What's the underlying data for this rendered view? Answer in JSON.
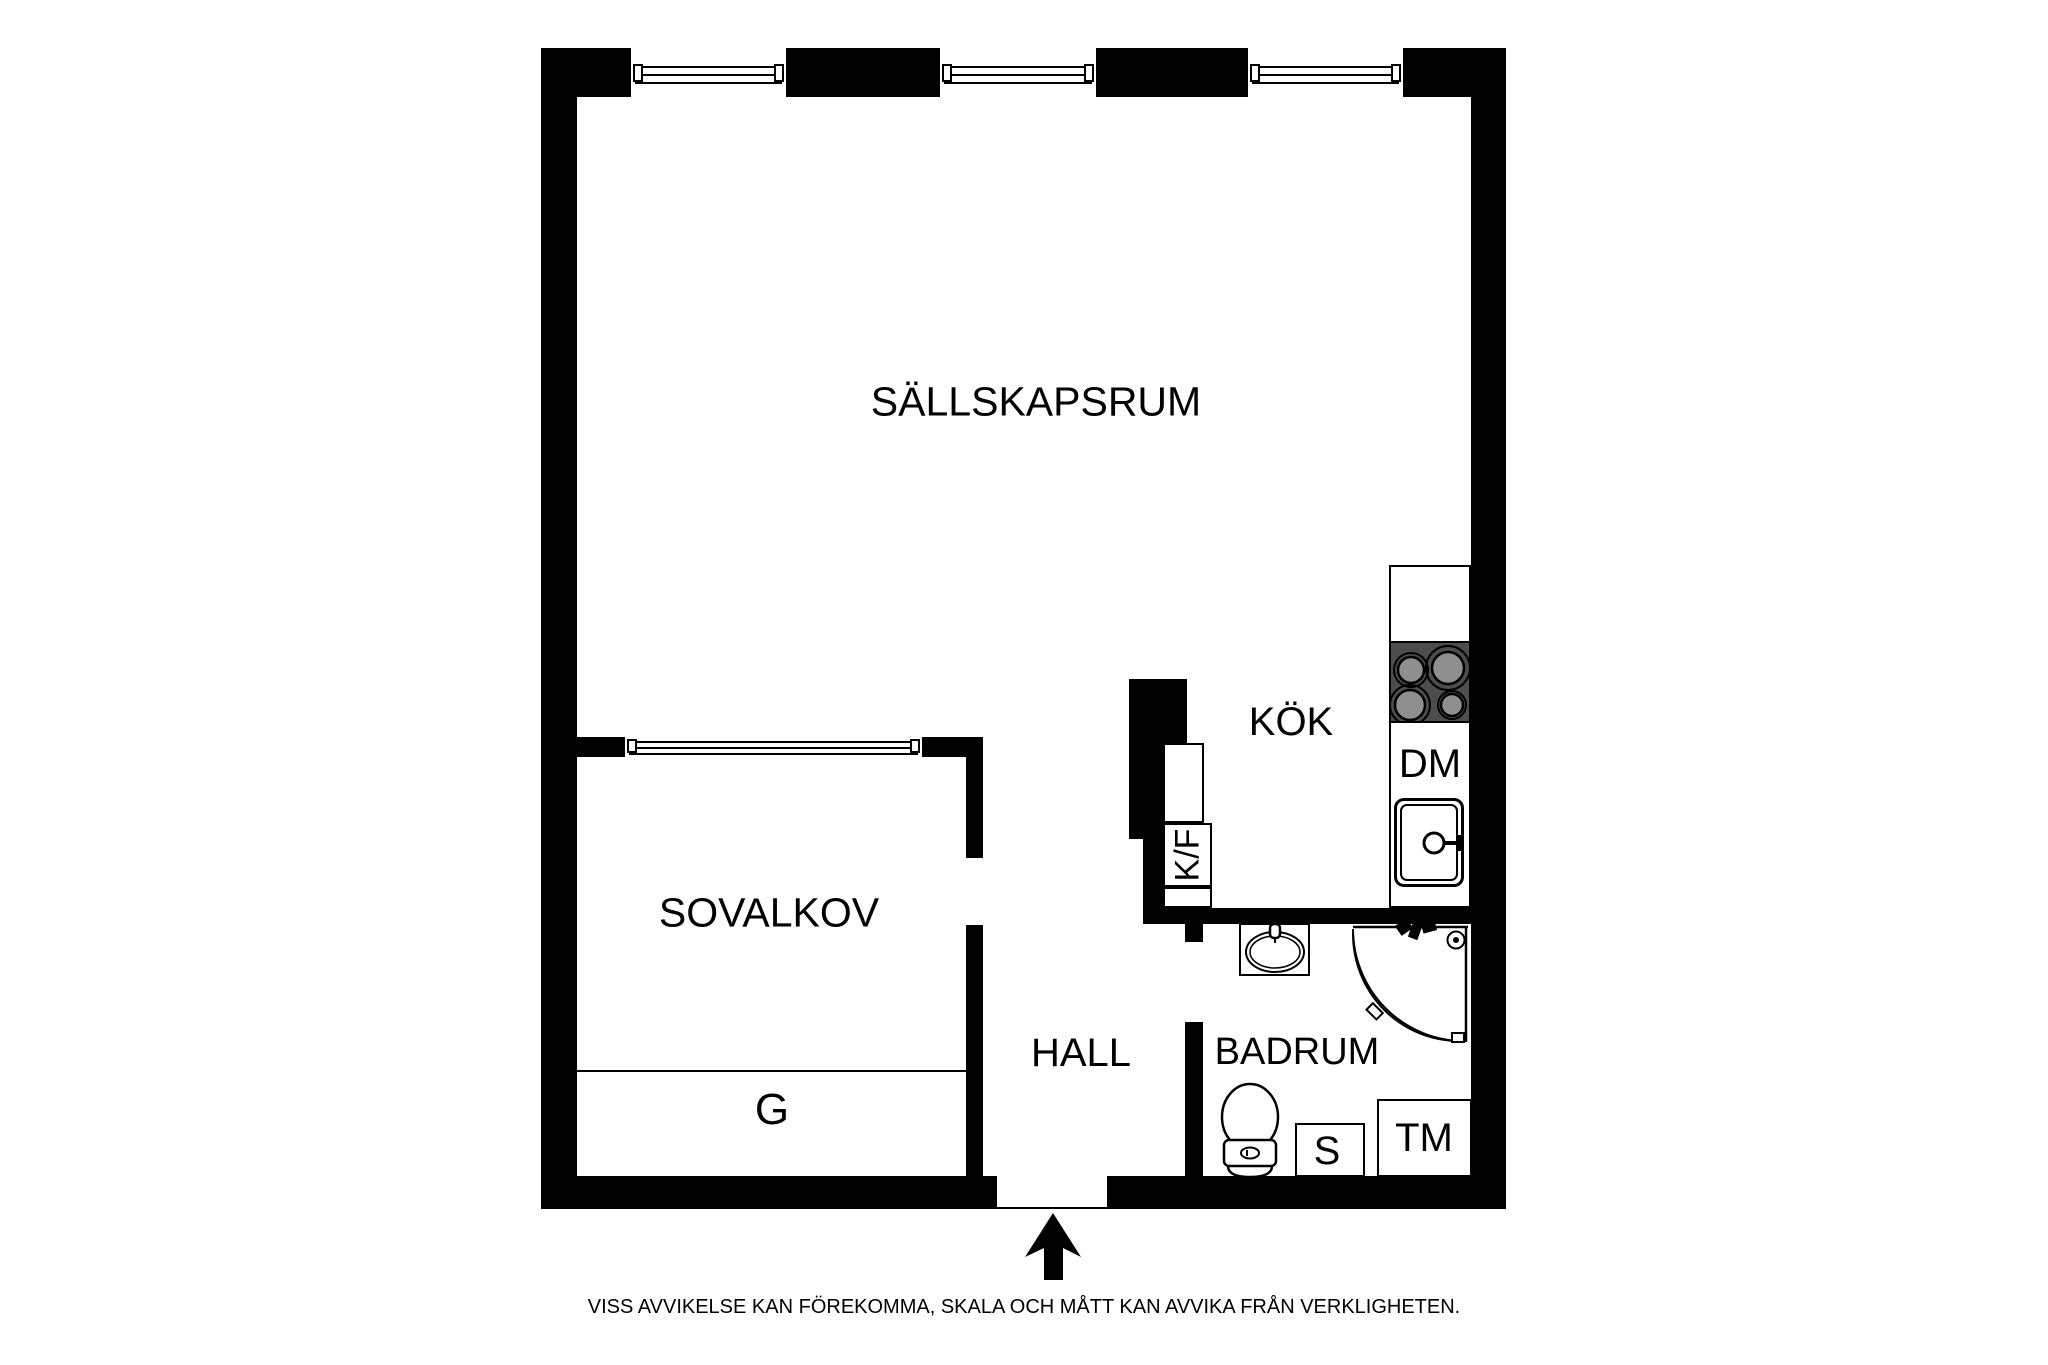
{
  "rooms": {
    "sallskapsrum": {
      "label": "SÄLLSKAPSRUM"
    },
    "sovalkov": {
      "label": "SOVALKOV"
    },
    "kok": {
      "label": "KÖK"
    },
    "hall": {
      "label": "HALL"
    },
    "badrum": {
      "label": "BADRUM"
    }
  },
  "appliances": {
    "dishwasher": {
      "label": "DM"
    },
    "fridge_freezer": {
      "label": "K/F"
    },
    "wardrobe": {
      "label": "G"
    },
    "sink_unit": {
      "label": "S"
    },
    "washing_machine": {
      "label": "TM"
    }
  },
  "disclaimer": "VISS AVVIKELSE KAN FÖREKOMMA, SKALA OCH MÅTT KAN AVVIKA FRÅN VERKLIGHETEN.",
  "colors": {
    "wall": "#000000",
    "background": "#ffffff",
    "stove_top": "#4d4d4d",
    "burner": "#8f8f8f"
  }
}
